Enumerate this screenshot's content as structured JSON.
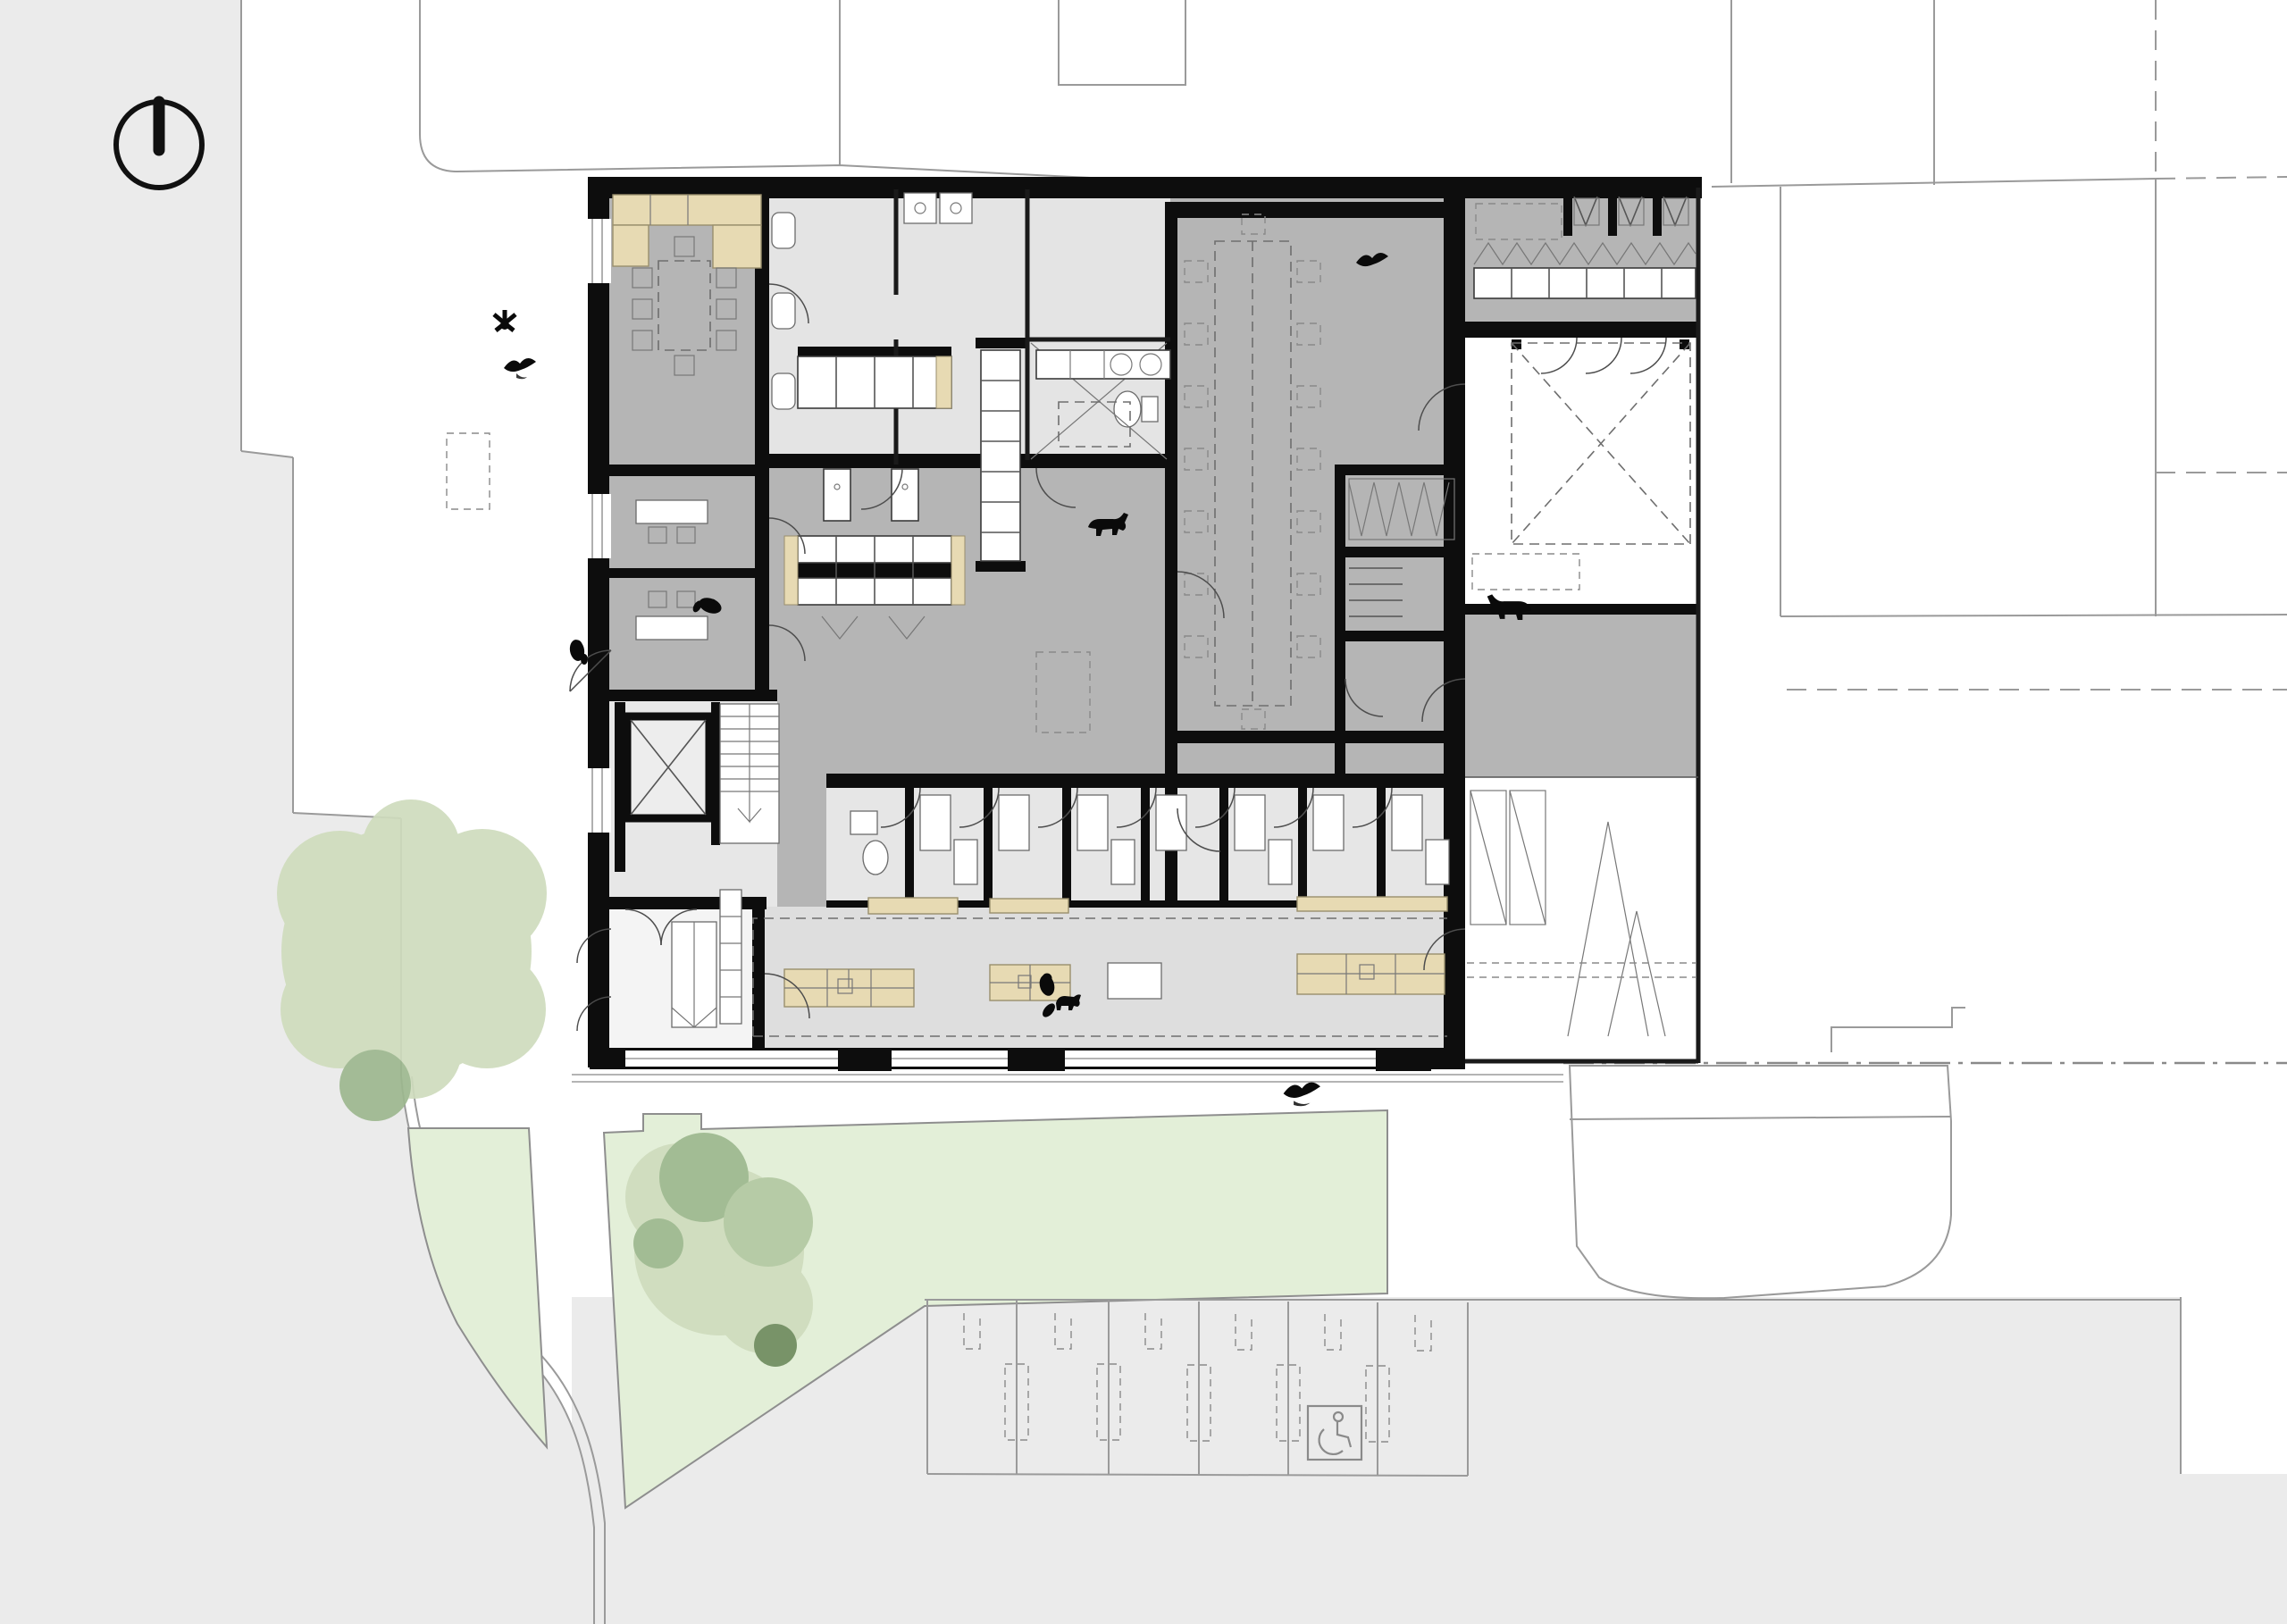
{
  "page": {
    "title": "Architectural ground-floor site plan (no text labels visible)",
    "drawing_type": "floor plan with site context",
    "visible_text": []
  },
  "colors": {
    "background": "#ffffff",
    "pavement_gray": "#ebebeb",
    "wall_black": "#0d0d0d",
    "floor_medium_gray": "#b5b5b5",
    "floor_light_gray": "#e4e4e4",
    "floor_waiting_gray": "#dedede",
    "floor_entrance_white": "#f4f4f4",
    "cabinet_tan": "#e7dab3",
    "cabinet_tan_edge": "#9a8f6d",
    "lawn_green": "#e3efd8",
    "lawn_edge": "#8e8e8e",
    "tree_light_green": "#cfdcbd",
    "tree_mid_green": "#b3c8a2",
    "tree_dark_green": "#9db88f",
    "tree_darkest_green": "#6f8c5f",
    "line_gray": "#9a9a9a",
    "silhouette_black": "#0a0a0a"
  },
  "north_arrow": {
    "present": true,
    "shape": "circle with vertical needle from top rim to center",
    "position": "top-left corner"
  },
  "site": {
    "pavement": "light gray street strip along left edge, curving road corner at bottom-left, full-width pavement at bottom",
    "curb": "white curb band following the curved road edge",
    "lawn": {
      "pieces": 2,
      "separator": "white walkway leading to west entrance",
      "notch": "small rectangular bump on upper edge of right lawn"
    },
    "trees": {
      "large_round_tree_left": 1,
      "small_dark_tree_under_it": 1,
      "cluster_on_lawn": {
        "light_blobs": 1,
        "dark_blobs": 3,
        "tiny_dark_tree": 1
      }
    },
    "parking": {
      "stall_count": 6,
      "stall_markings": "thin dividers with dashed center strips",
      "accessible_stall": {
        "present": true,
        "icon": "wheelchair symbol in thin outlined square",
        "stall_index_from_left": 5
      }
    },
    "boundaries": "thin gray parcel lines, partly dashed, dash-dot street boundary at bottom right",
    "neighbor_building": "rounded trapezoid footprint outline at bottom right",
    "forecourt": "double curb lines and three black threshold piers below the south facade"
  },
  "building": {
    "construction": "thick black poché walls, main block plus thin-walled east wing",
    "zones": [
      {
        "name": "meeting-room",
        "tone": "medium gray",
        "contents": "tan kitchen run, dashed table with chairs"
      },
      {
        "name": "offices-west",
        "tone": "medium gray",
        "contents": "desks and chairs"
      },
      {
        "name": "sanitary-core",
        "tone": "light gray",
        "contents": "WCs, sinks, shower room with diagonal tiling lines"
      },
      {
        "name": "treatment-lab",
        "tone": "medium gray",
        "contents": "kennel banks with tan end panels, exam tables, cage column, washer counter"
      },
      {
        "name": "multipurpose-hall",
        "tone": "medium gray",
        "contents": "long dashed conference table with 16 dashed chairs"
      },
      {
        "name": "locker-storage-rooms",
        "tone": "medium gray",
        "contents": "zig-zag locker symbols, shelf lines"
      },
      {
        "name": "cloakroom-band-east-wing",
        "tone": "medium gray",
        "contents": "three cells with V symbols, bench row with hanger zig-zag"
      },
      {
        "name": "consult-rooms-row",
        "tone": "light gray",
        "count": 8,
        "contents": "desks, benches, one WC"
      },
      {
        "name": "waiting-area",
        "tone": "pale gray",
        "contents": "tan bench blocks, tan counters, dashed floor boundary"
      },
      {
        "name": "entrance-lobby",
        "tone": "white",
        "contents": "ramp with chevron arrow, cabinet column, double doors"
      },
      {
        "name": "stair-elevator-block",
        "tone": "light gray",
        "contents": "elevator shaft with X, stair with treads"
      },
      {
        "name": "courtyard",
        "tone": "white",
        "contents": "dashed square skylight with X diagonals"
      },
      {
        "name": "east-passage",
        "tone": "medium gray"
      },
      {
        "name": "garage",
        "tone": "white",
        "contents": "two door leaves, ramp chevrons, dashed lines"
      }
    ],
    "occupants": [
      {
        "type": "bird",
        "location": "over meeting room"
      },
      {
        "type": "plant",
        "location": "meeting room corner"
      },
      {
        "type": "person",
        "location": "west corridor near stair"
      },
      {
        "type": "person",
        "location": "outside west entrance"
      },
      {
        "type": "dog",
        "location": "treatment area"
      },
      {
        "type": "dog",
        "location": "east passage"
      },
      {
        "type": "bird",
        "location": "top of multipurpose hall"
      },
      {
        "type": "person-with-dog",
        "location": "waiting area"
      },
      {
        "type": "bird",
        "location": "forecourt sidewalk"
      }
    ]
  }
}
